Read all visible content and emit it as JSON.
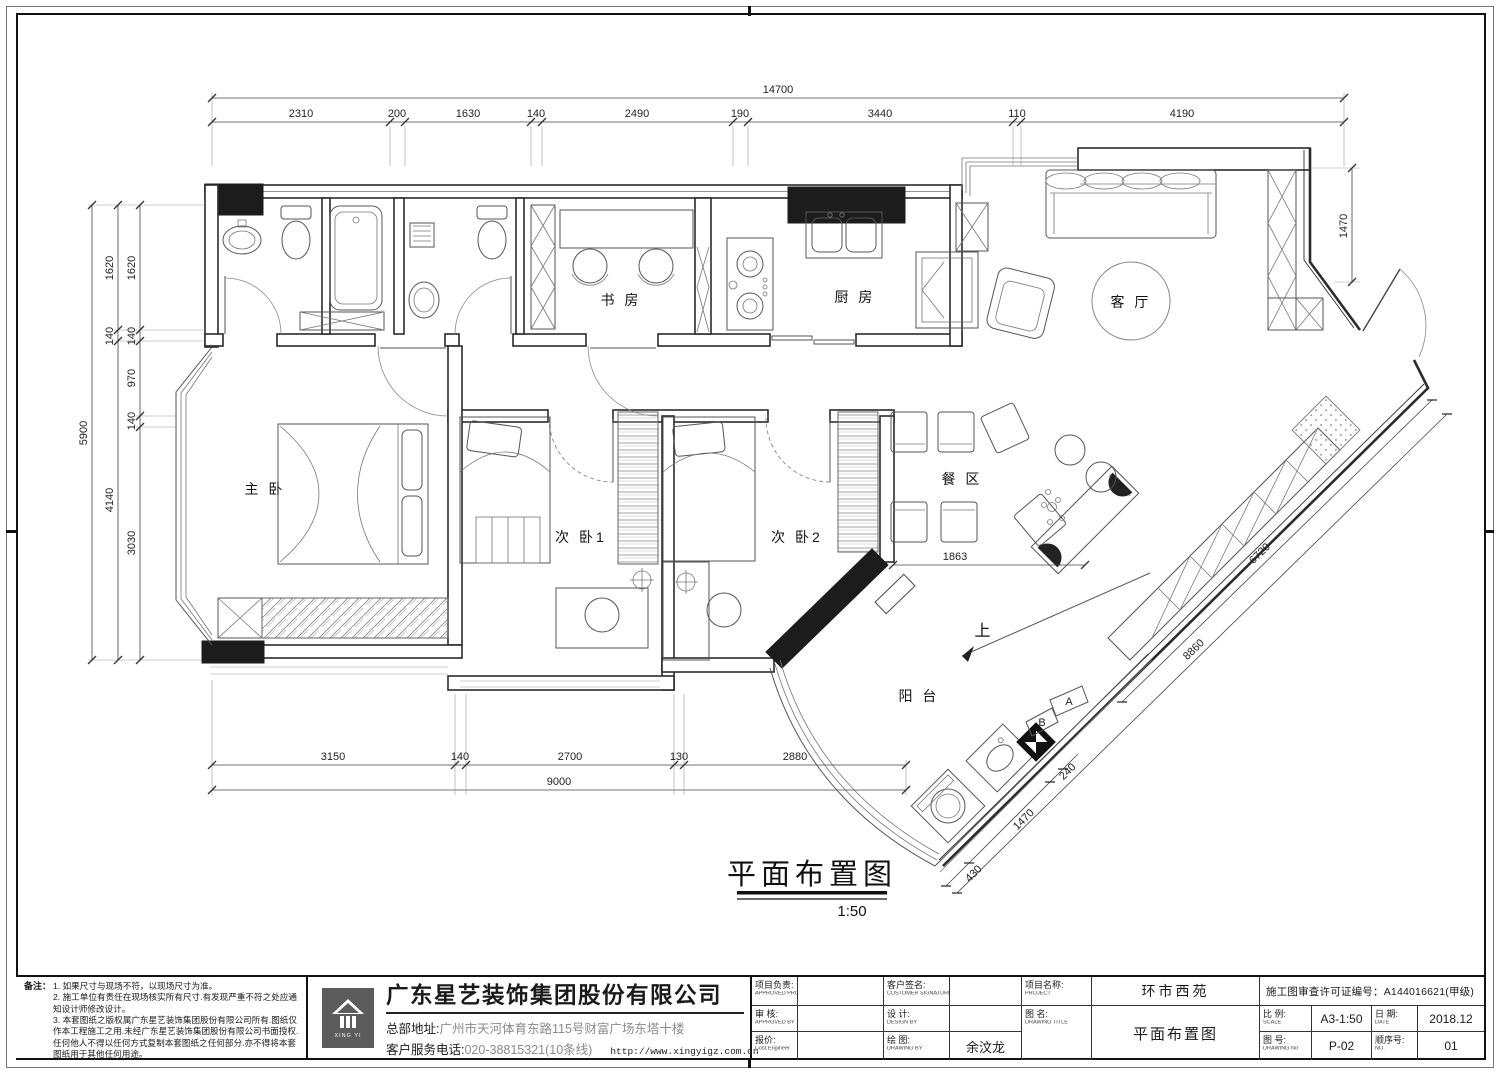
{
  "sheet": {
    "plan_title": "平面布置图",
    "plan_scale": "1:50"
  },
  "rooms": {
    "master": "主 卧",
    "bed2": "次 卧1",
    "bed3": "次 卧2",
    "study": "书 房",
    "kitchen": "厨 房",
    "living": "客 厅",
    "dining": "餐 区",
    "balcony": "阳 台",
    "stairs_up": "上"
  },
  "markers": {
    "a": "A",
    "b": "B"
  },
  "dims": {
    "top_total": "14700",
    "top": [
      "2310",
      "200",
      "1630",
      "140",
      "2490",
      "190",
      "3440",
      "110",
      "4190"
    ],
    "left_total": "5900",
    "left_outer": [
      "1620",
      "140",
      "4140"
    ],
    "left_inner": [
      "1620",
      "140",
      "970",
      "140",
      "3030"
    ],
    "bottom": [
      "3150",
      "140",
      "2700",
      "130",
      "2880"
    ],
    "bottom_total": "9000",
    "living_right": "1470",
    "diagonal_inner": "6720",
    "diagonal_outer": "8860",
    "balcony": [
      "430",
      "1470",
      "240"
    ],
    "dining_width": "1863"
  },
  "notes": {
    "label": "备注：",
    "line1": "1. 如果尺寸与现场不符，以现场尺寸为准。",
    "line2": "2. 施工单位有责任在现场核实所有尺寸.有发现严重不符之处应通知设计师修改设计。",
    "line3": "3. 本套图纸之版权属广东星艺装饰集团股份有限公司所有.图纸仅作本工程施工之用.未经广东星艺装饰集团股份有限公司书面授权.任何他人不得以任何方式复制本套图纸之任何部分.亦不得将本套图纸用于其他任何用途。"
  },
  "company": {
    "name": "广东星艺装饰集团股份有限公司",
    "logo_text": "XING YI",
    "address_label": "总部地址:",
    "address": "广州市天河体育东路115号财富广场东塔十楼",
    "phone_label": "客户服务电话:",
    "phone": "020-38815321(10条线)",
    "url": "http://www.xingyigz.com.cn"
  },
  "titleblock": {
    "approved_project": "项目负责:",
    "approved_project_en": "APPROVED PROJECT BY",
    "customer": "客户签名:",
    "customer_en": "CUSTOMER SIGNATURE BY",
    "project": "项目名称:",
    "project_en": "PROJECT",
    "project_value": "环市西苑",
    "permit": "施工图审查许可证编号：A144016621(甲级)",
    "check": "审 核:",
    "check_en": "APPROVED BY",
    "design": "设 计:",
    "design_en": "DESIGN BY",
    "drawing_name": "图 名:",
    "drawing_name_en": "DRAWING TITLE",
    "drawing_name_value": "平面布置图",
    "scale": "比 例:",
    "scale_en": "SCALE",
    "scale_value": "A3-1:50",
    "date": "日 期:",
    "date_en": "DATE",
    "date_value": "2018.12",
    "cost": "报价:",
    "cost_en": "Cost Engineer",
    "drawn": "绘 图:",
    "drawn_en": "DRAWING BY",
    "drawn_value": "余汶龙",
    "number": "图 号:",
    "number_en": "DRAWING No",
    "number_value": "P-02",
    "seq": "顺序号:",
    "seq_en": "NO.",
    "seq_value": "01"
  }
}
